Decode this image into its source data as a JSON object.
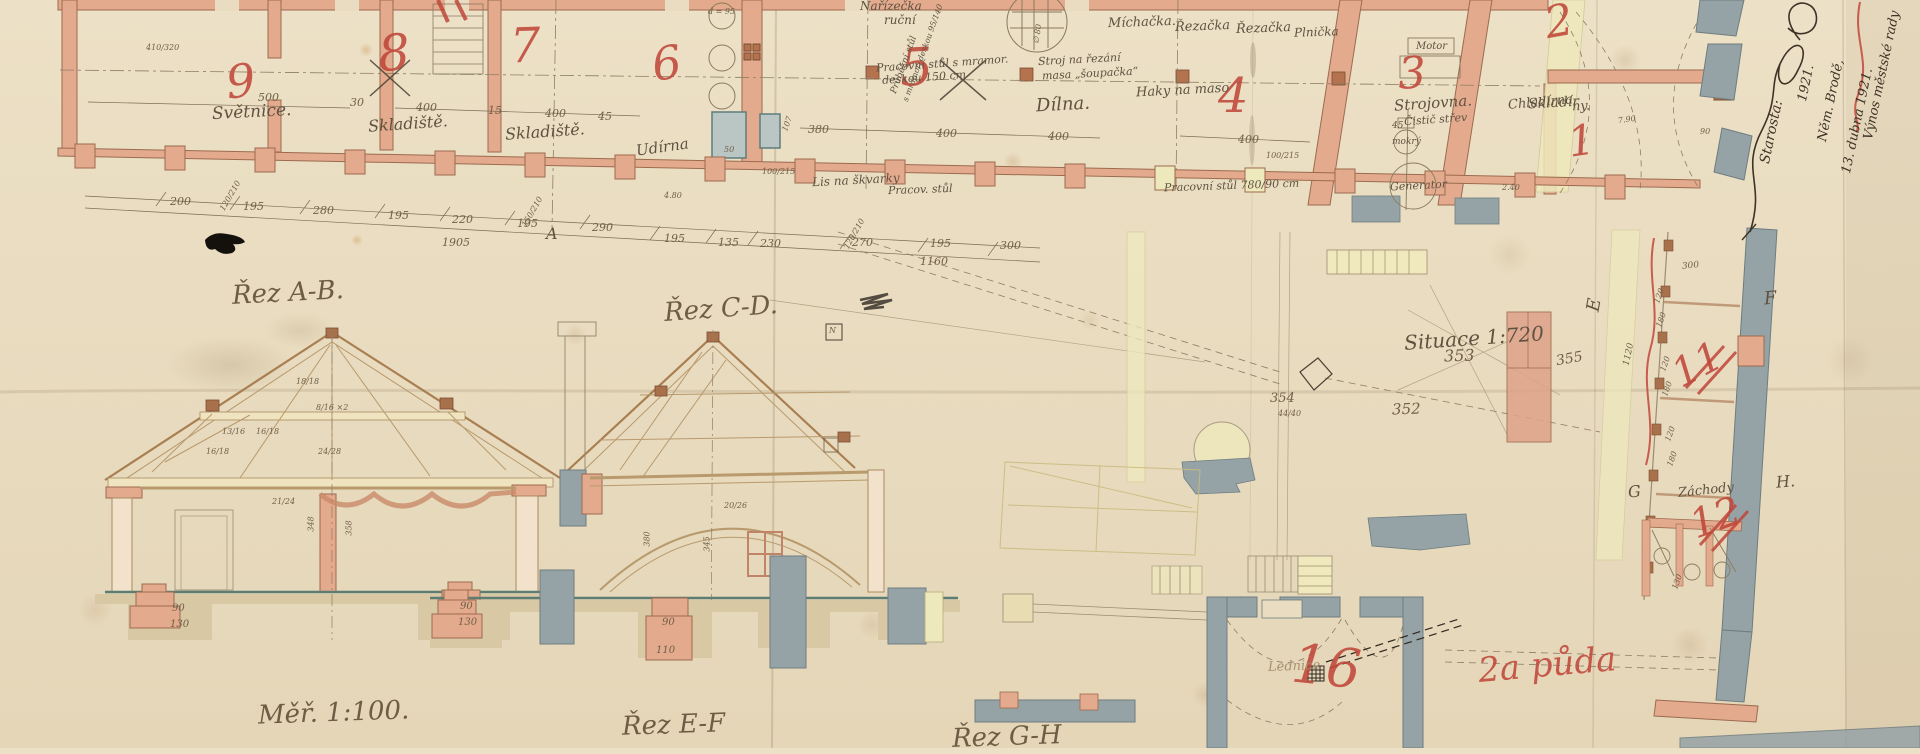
{
  "palette": {
    "paper": "#e9dcc0",
    "ink": "#5f5240",
    "pencil": "#6f5f48",
    "red_ink": "#c0473a",
    "wall_pink": "#e3aa8d",
    "wall_grey": "#96a3a6",
    "wash_yellow": "#efe9bd",
    "wood": "#b08860",
    "foundation": "#d8c8a4",
    "floor_teal": "#5e7d72"
  },
  "plan": {
    "numbers": {
      "r9": "9",
      "r8": "8",
      "r7": "7",
      "r6": "6",
      "r5": "5",
      "r4": "4",
      "r3": "3",
      "r2": "2",
      "r1": "1",
      "r16": "16",
      "r11": "11",
      "r12": "12",
      "partial": "11",
      "attic": "2a půda"
    },
    "labels": {
      "svetnice": "Světnice.",
      "sklad1": "Skladiště.",
      "sklad2": "Skladiště.",
      "udirna": "Udírna",
      "dilna": "Dílna.",
      "strojovna": "Strojovna.",
      "sklad3a": "Skladír",
      "sklad3b": "ny.",
      "chladirna": "Chladírna",
      "zachody": "Záchody",
      "lednice": "Lednice",
      "haky": "Haky na maso"
    },
    "equipment": {
      "narizecka": "Nařízečka",
      "rucni": "ruční",
      "prubezny_a": "Průběžní stůl",
      "prubezny_b": "s mramor. deskou 95/140",
      "prac5a": "Pracovní stůl s mramor.",
      "prac5b": "deskou 150 cm",
      "stroj_a": "Stroj na řezání",
      "stroj_b": "masa „šoupačka“",
      "lis": "Lis na škvarky",
      "prac4a": "Pracov. stůl",
      "prac4b": "Pracovní stůl 780/90 cm",
      "michacka": "Míchačka.",
      "rezacka1": "Řezačka",
      "rezacka2": "Řezačka",
      "plnicka": "Plnička",
      "motor": "Motor",
      "mokry": "mokrý",
      "generator": "Generator",
      "cistic": "Čistič střev",
      "d95": "d = 95",
      "v45": "45",
      "v50": "50",
      "v107": "107",
      "prum80": "∅ 80"
    },
    "dims_upper": [
      "500",
      "30",
      "400",
      "15",
      "400",
      "45",
      "380",
      "400",
      "400",
      "400"
    ],
    "dims_lower": [
      "200",
      "195",
      "280",
      "195",
      "220",
      "195",
      "290",
      "195",
      "135",
      "230",
      "270",
      "195",
      "300"
    ],
    "totals": [
      "1905",
      "1160"
    ],
    "small_dims": [
      "100/215",
      "100/215",
      "120/210",
      "150/210",
      "120/210",
      "4.80",
      "410/320",
      "7.90",
      "90",
      "2.40"
    ]
  },
  "sections": {
    "titles": {
      "ab": "Řez A-B.",
      "cd": "Řez C-D.",
      "ef": "Řez E-F",
      "gh": "Řez G-H",
      "scale": "Měř. 1:100."
    },
    "timber": [
      "13/16",
      "16/18",
      "18/18",
      "8/16 ×2",
      "16/18",
      "24/28",
      "21/24"
    ],
    "dims": {
      "a90": "90",
      "a130": "130",
      "b90": "90",
      "b130": "130",
      "c90": "90",
      "c110": "110",
      "v348": "348",
      "v358": "358",
      "v380": "380",
      "v345": "345",
      "arch": "20/26"
    }
  },
  "site": {
    "title": "Situace 1:720",
    "elev": {
      "e353": "353",
      "e352": "352",
      "e355": "355",
      "e354": "354",
      "frac": "44/40"
    },
    "markers": {
      "a": "A",
      "e": "E",
      "f": "F",
      "g": "G",
      "h": "H.",
      "n": "N"
    },
    "wing_dims": [
      "300",
      "120",
      "180",
      "120",
      "180",
      "120",
      "180",
      "130",
      "1120"
    ]
  },
  "annotations": {
    "approval": [
      "Výnos městské rady",
      "13. dubna 1921.",
      "Něm. Brodě,",
      "1921."
    ],
    "starosta": "Starosta:"
  }
}
